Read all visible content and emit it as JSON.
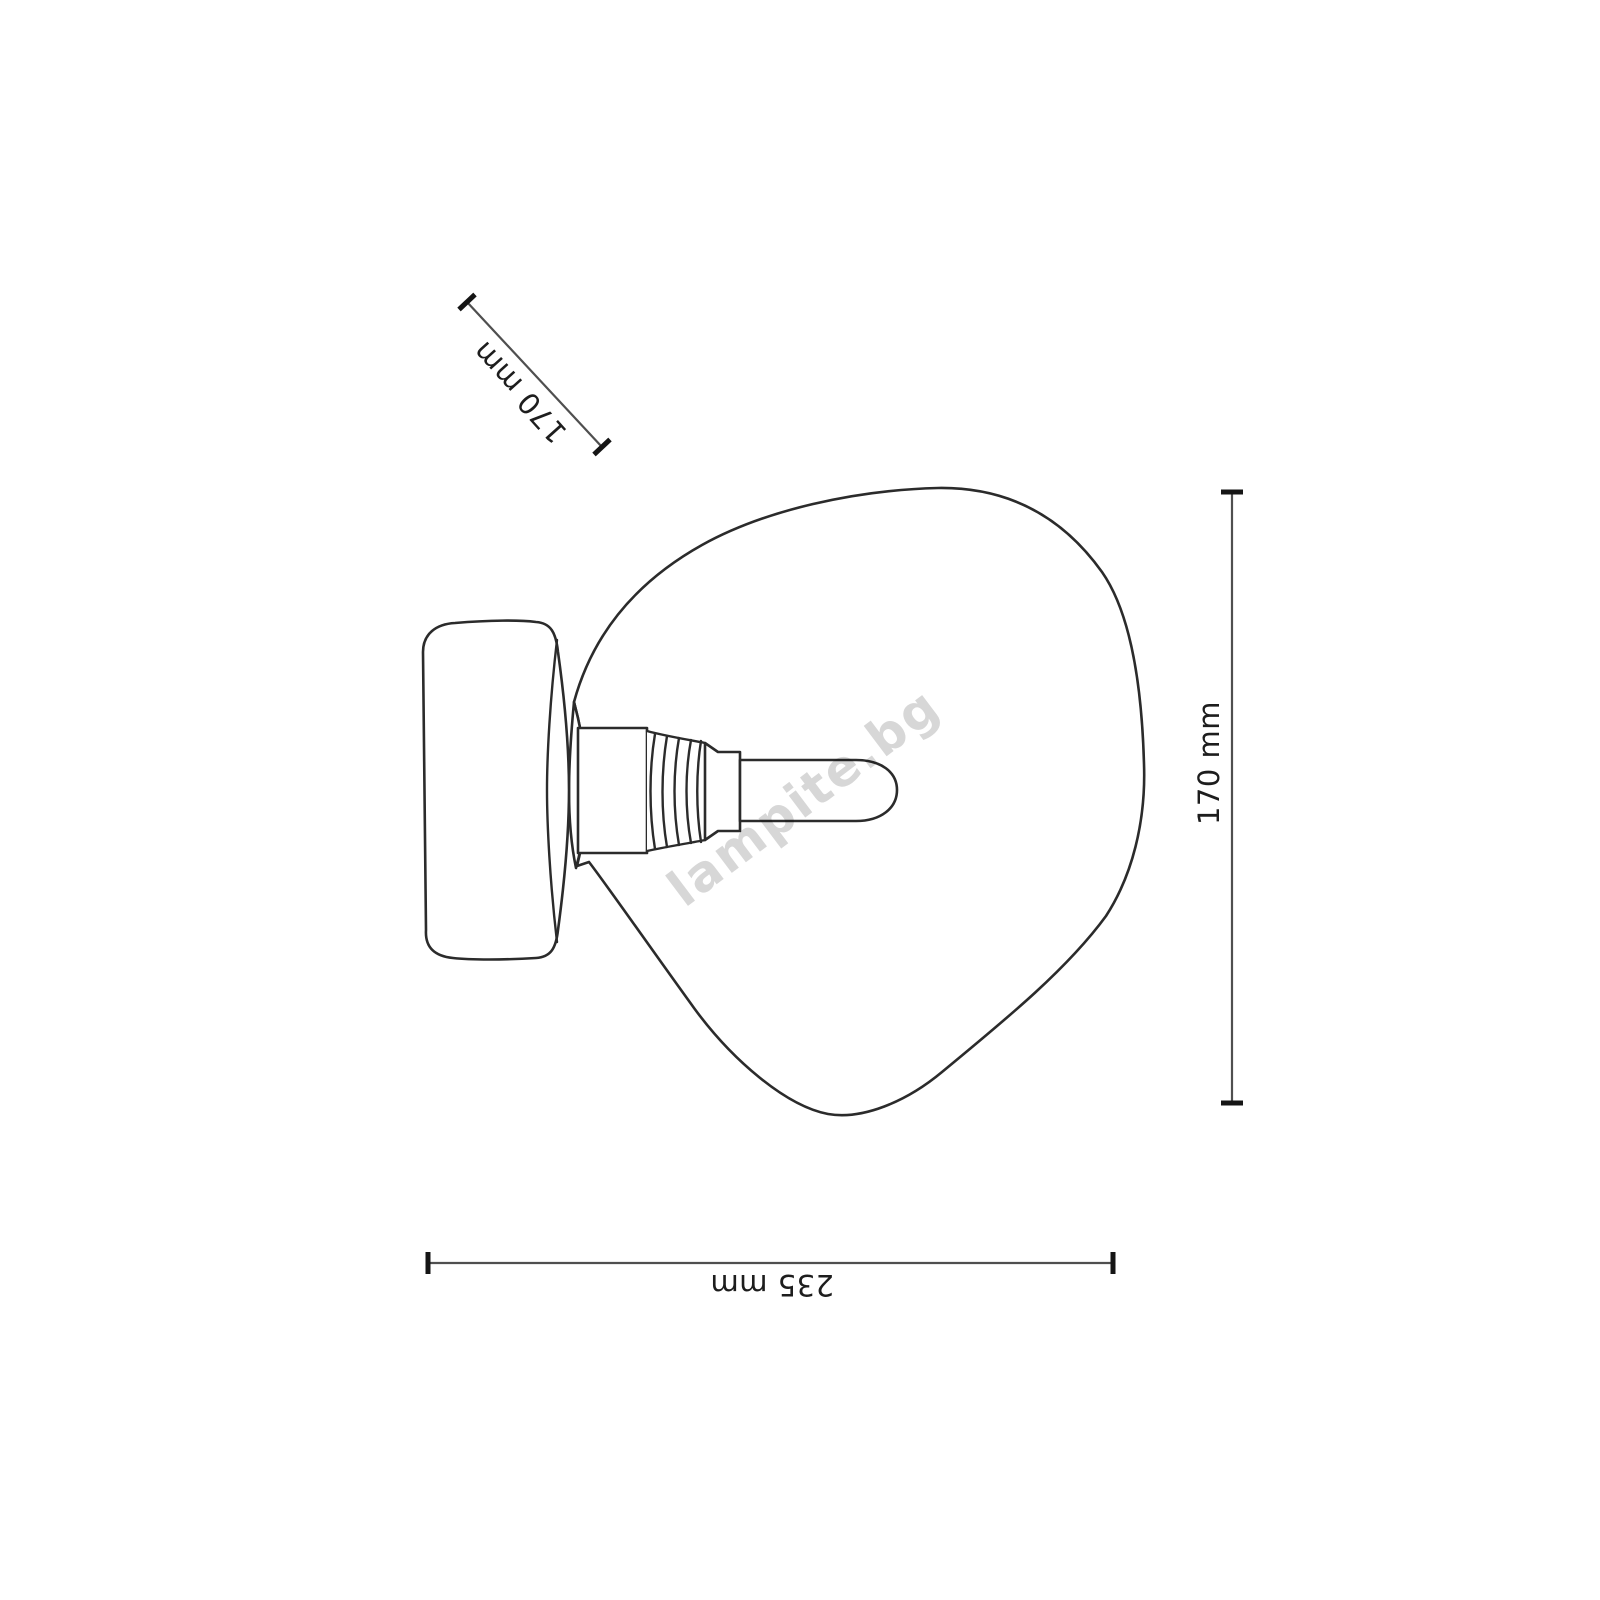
{
  "watermark": {
    "text": "lampite.bg",
    "color": "#d7d7d7"
  },
  "dimensions": {
    "diagonal": {
      "label": "170 mm"
    },
    "vertical": {
      "label": "170 mm"
    },
    "horizontal": {
      "label": "235 mm"
    }
  },
  "colors": {
    "background": "#ffffff",
    "outline": "#2b2b2b",
    "dimension_line": "#4f4f4f",
    "tick": "#151515",
    "label_text": "#1d1d1d",
    "watermark": "#d7d7d7"
  }
}
